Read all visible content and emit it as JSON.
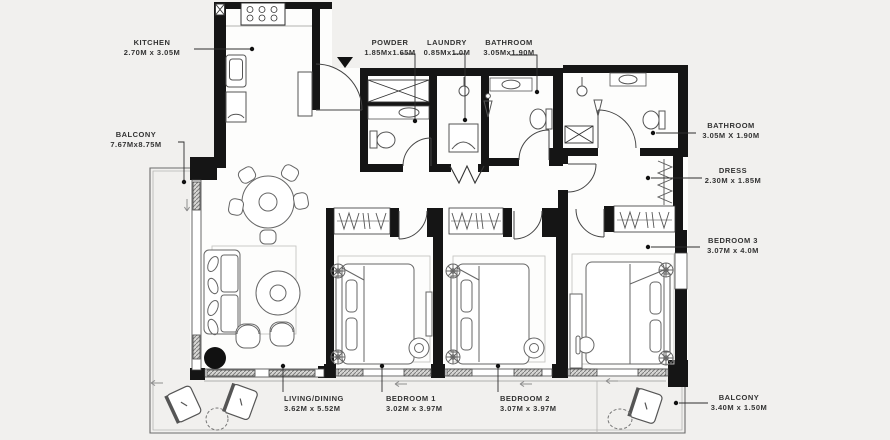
{
  "rooms": {
    "kitchen": {
      "name": "KITCHEN",
      "dims": "2.70M x 3.05M"
    },
    "balcony_left": {
      "name": "BALCONY",
      "dims": "7.67Mx8.75M"
    },
    "powder": {
      "name": "POWDER",
      "dims": "1.85Mx1.65M"
    },
    "laundry": {
      "name": "LAUNDRY",
      "dims": "0.85Mx1.0M"
    },
    "bathroom_top": {
      "name": "BATHROOM",
      "dims": "3.05Mx1.90M"
    },
    "bathroom_right": {
      "name": "BATHROOM",
      "dims": "3.05M X 1.90M"
    },
    "dress": {
      "name": "DRESS",
      "dims": "2.30M x 1.85M"
    },
    "bedroom3": {
      "name": "BEDROOM 3",
      "dims": "3.07M x 4.0M"
    },
    "living": {
      "name": "LIVING/DINING",
      "dims": "3.62M x 5.52M"
    },
    "bedroom1": {
      "name": "BEDROOM 1",
      "dims": "3.02M x 3.97M"
    },
    "bedroom2": {
      "name": "BEDROOM 2",
      "dims": "3.07M x 3.97M"
    },
    "balcony_bottom": {
      "name": "BALCONY",
      "dims": "3.40M x 1.50M"
    }
  },
  "icons": {
    "entry_marker": "entry-arrow-down"
  },
  "colors": {
    "background": "#f1f0ee",
    "wall": "#151515",
    "line": "#555555",
    "text": "#333333"
  }
}
